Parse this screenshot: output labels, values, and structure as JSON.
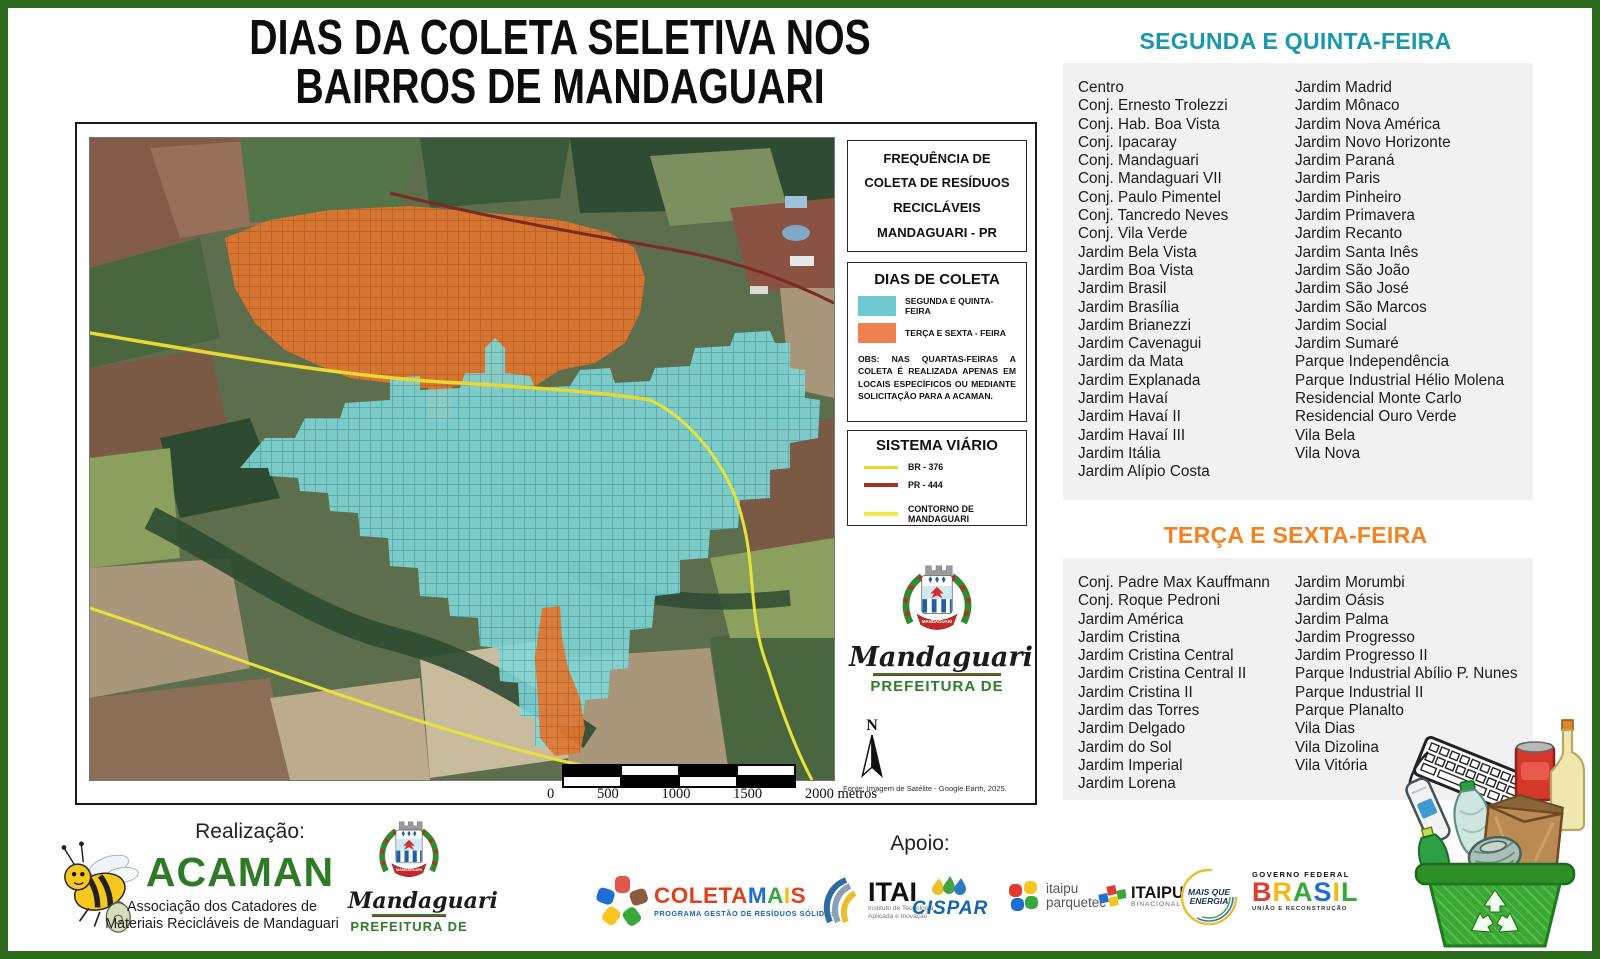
{
  "title": {
    "line1": "DIAS DA COLETA SELETIVA NOS",
    "line2": "BAIRROS DE MANDAGUARI"
  },
  "map": {
    "freq_box": {
      "lines": [
        "FREQUÊNCIA DE",
        "COLETA DE RESÍDUOS",
        "RECICLÁVEIS",
        "MANDAGUARI - PR"
      ]
    },
    "legend": {
      "title": "DIAS DE COLETA",
      "items": [
        {
          "label": "SEGUNDA E QUINTA-FEIRA",
          "color": "#6fc9d1"
        },
        {
          "label": "TERÇA E SEXTA - FEIRA",
          "color": "#f08050"
        }
      ],
      "obs": "OBS: NAS QUARTAS-FEIRAS A COLETA É REALIZADA APENAS EM LOCAIS ESPECÍFICOS OU MEDIANTE SOLICITAÇÃO PARA A ACAMAN."
    },
    "roads": {
      "title": "SISTEMA VIÁRIO",
      "items": [
        {
          "label": "BR - 376",
          "color": "#f3d32c"
        },
        {
          "label": "PR - 444",
          "color": "#a33227"
        },
        {
          "label": "CONTORNO DE MANDAGUARI",
          "color": "#f6e34b"
        }
      ]
    },
    "overlay_colors": {
      "monday_thursday": "#7fd8da",
      "tuesday_friday": "#e0762f"
    },
    "city_logo": {
      "name": "Mandaguari",
      "sub": "PREFEITURA DE",
      "ribbon": "MANDAGUARI"
    },
    "north_label": "N",
    "fonte": "Fonte: Imagem de Satélite - Google Earth, 2025.",
    "scale_labels": [
      "0",
      "500",
      "1000",
      "1500",
      "2000 metros"
    ]
  },
  "monday_list": {
    "title": "SEGUNDA E QUINTA-FEIRA",
    "color": "#1898ae",
    "col1": [
      "Centro",
      "Conj. Ernesto Trolezzi",
      "Conj. Hab. Boa Vista",
      "Conj. Ipacaray",
      "Conj. Mandaguari",
      "Conj. Mandaguari VII",
      "Conj. Paulo Pimentel",
      "Conj. Tancredo Neves",
      "Conj. Vila Verde",
      "Jardim Bela Vista",
      "Jardim Boa Vista",
      "Jardim Brasil",
      "Jardim Brasília",
      "Jardim Brianezzi",
      "Jardim Cavenagui",
      "Jardim da Mata",
      "Jardim Explanada",
      "Jardim Havaí",
      "Jardim Havaí II",
      "Jardim Havaí III",
      "Jardim Itália",
      "Jardim Alípio Costa"
    ],
    "col2": [
      "Jardim Madrid",
      "Jardim Mônaco",
      "Jardim Nova América",
      "Jardim Novo Horizonte",
      "Jardim Paraná",
      "Jardim Paris",
      "Jardim Pinheiro",
      "Jardim Primavera",
      "Jardim Recanto",
      "Jardim Santa Inês",
      "Jardim São João",
      "Jardim São José",
      "Jardim São Marcos",
      "Jardim Social",
      "Jardim Sumaré",
      "Parque Independência",
      "Parque Industrial Hélio Molena",
      "Residencial Monte Carlo",
      "Residencial Ouro Verde",
      "Vila Bela",
      "Vila Nova"
    ]
  },
  "tuesday_list": {
    "title": "TERÇA E SEXTA-FEIRA",
    "color": "#f58220",
    "col1": [
      "Conj. Padre Max Kauffmann",
      "Conj. Roque Pedroni",
      "Jardim América",
      "Jardim Cristina",
      "Jardim Cristina Central",
      "Jardim Cristina Central II",
      "Jardim Cristina II",
      "Jardim das Torres",
      "Jardim Delgado",
      "Jardim do Sol",
      "Jardim Imperial",
      "Jardim Lorena"
    ],
    "col2": [
      "Jardim Morumbi",
      "Jardim Oásis",
      "Jardim Palma",
      "Jardim Progresso",
      "Jardim Progresso II",
      "Parque Industrial Abílio P. Nunes",
      "Parque Industrial II",
      "Parque Planalto",
      "Vila Dias",
      "Vila Dizolina",
      "Vila Vitória"
    ]
  },
  "footer": {
    "realizacao": "Realização:",
    "acaman": {
      "name": "ACAMAN",
      "desc1": "Associação dos Catadores de",
      "desc2": "Materiais Recicláveis de Mandaguari"
    },
    "apoio": "Apoio:",
    "logos": {
      "coletamais": {
        "letters": [
          {
            "ch": "C",
            "c": "#e2401b"
          },
          {
            "ch": "O",
            "c": "#e2401b"
          },
          {
            "ch": "L",
            "c": "#e2401b"
          },
          {
            "ch": "E",
            "c": "#e2401b"
          },
          {
            "ch": "T",
            "c": "#e2401b"
          },
          {
            "ch": "A",
            "c": "#e2401b"
          },
          {
            "ch": "M",
            "c": "#1f6fd0"
          },
          {
            "ch": "A",
            "c": "#37a93c"
          },
          {
            "ch": "I",
            "c": "#f7b90f"
          },
          {
            "ch": "S",
            "c": "#e2401b"
          }
        ],
        "subtitle": "PROGRAMA GESTÃO DE RESÍDUOS SÓLIDOS"
      },
      "itai": {
        "name": "ITAI",
        "sub1": "Instituto de Tecnologia",
        "sub2": "Aplicada e Inovação"
      },
      "cispar": {
        "name": "CISPAR"
      },
      "parquetec": {
        "line1": "itaipu",
        "line2": "parquetec"
      },
      "itaipu": {
        "name": "ITAIPU",
        "sub": "BINACIONAL"
      },
      "energia": {
        "line1": "MAIS QUE",
        "line2": "ENERGIA"
      },
      "governo": {
        "top": "GOVERNO FEDERAL",
        "letters": [
          {
            "ch": "B",
            "c": "#e23a2e"
          },
          {
            "ch": "R",
            "c": "#f7b90f"
          },
          {
            "ch": "A",
            "c": "#37a93c"
          },
          {
            "ch": "S",
            "c": "#1f6fd0"
          },
          {
            "ch": "I",
            "c": "#f7b90f"
          },
          {
            "ch": "L",
            "c": "#37a93c"
          }
        ],
        "sub": "UNIÃO E RECONSTRUÇÃO"
      }
    }
  }
}
